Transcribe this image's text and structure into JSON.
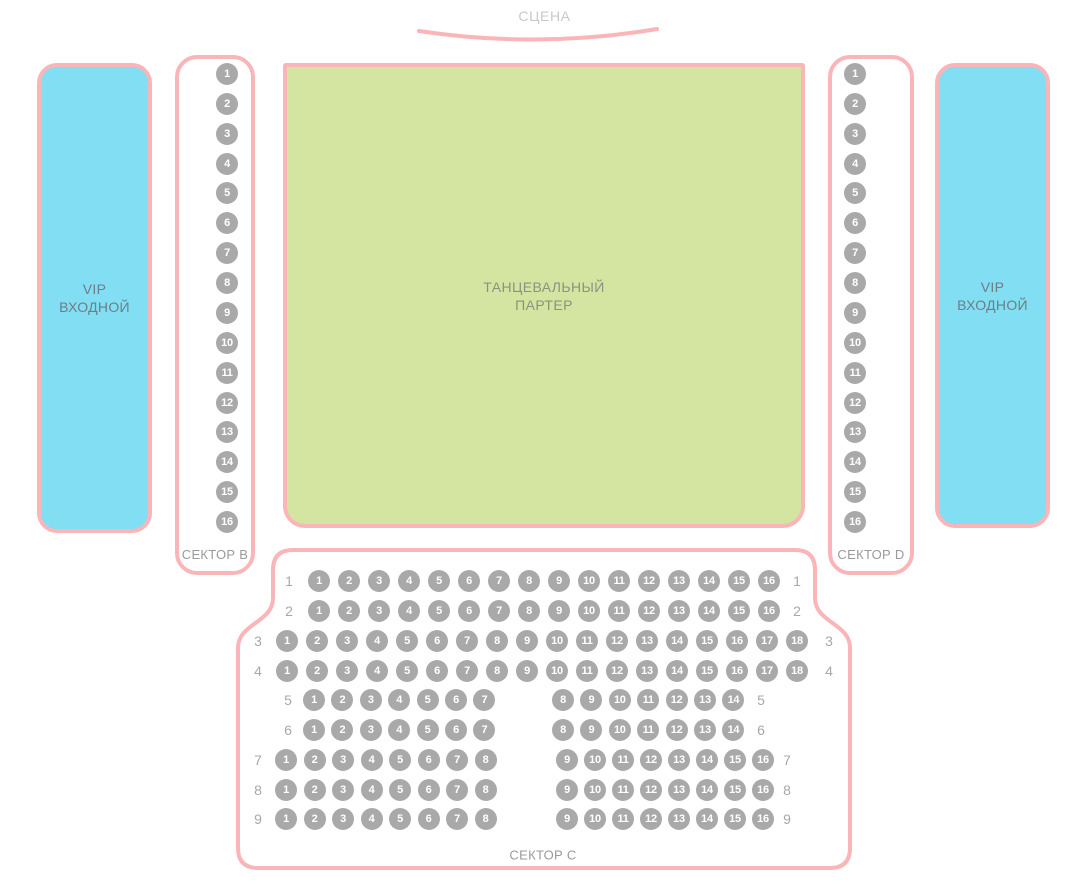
{
  "colors": {
    "pink": "#f9b5b8",
    "cyan": "#82def2",
    "green": "#d3e5a1",
    "seat": "#a9a9a9",
    "seat_number": "#ffffff"
  },
  "stage": {
    "label": "СЦЕНА"
  },
  "vip_left": {
    "line1": "VIP",
    "line2": "ВХОДНОЙ"
  },
  "vip_right": {
    "line1": "VIP",
    "line2": "ВХОДНОЙ"
  },
  "dance_floor": {
    "line1": "ТАНЦЕВАЛЬНЫЙ",
    "line2": "ПАРТЕР"
  },
  "sector_b": {
    "label": "СЕКТОР B",
    "seats": [
      "1",
      "2",
      "3",
      "4",
      "5",
      "6",
      "7",
      "8",
      "9",
      "10",
      "11",
      "12",
      "13",
      "14",
      "15",
      "16"
    ]
  },
  "sector_d": {
    "label": "СЕКТОР D",
    "seats": [
      "1",
      "2",
      "3",
      "4",
      "5",
      "6",
      "7",
      "8",
      "9",
      "10",
      "11",
      "12",
      "13",
      "14",
      "15",
      "16"
    ]
  },
  "sector_c": {
    "label": "СЕКТОР C",
    "rows": [
      {
        "label": "1",
        "groups": [
          [
            "1",
            "2",
            "3",
            "4",
            "5",
            "6",
            "7",
            "8",
            "9",
            "10",
            "11",
            "12",
            "13",
            "14",
            "15",
            "16"
          ]
        ]
      },
      {
        "label": "2",
        "groups": [
          [
            "1",
            "2",
            "3",
            "4",
            "5",
            "6",
            "7",
            "8",
            "9",
            "10",
            "11",
            "12",
            "13",
            "14",
            "15",
            "16"
          ]
        ]
      },
      {
        "label": "3",
        "groups": [
          [
            "1",
            "2",
            "3",
            "4",
            "5",
            "6",
            "7",
            "8",
            "9",
            "10",
            "11",
            "12",
            "13",
            "14",
            "15",
            "16",
            "17",
            "18"
          ]
        ]
      },
      {
        "label": "4",
        "groups": [
          [
            "1",
            "2",
            "3",
            "4",
            "5",
            "6",
            "7",
            "8",
            "9",
            "10",
            "11",
            "12",
            "13",
            "14",
            "15",
            "16",
            "17",
            "18"
          ]
        ]
      },
      {
        "label": "5",
        "groups": [
          [
            "1",
            "2",
            "3",
            "4",
            "5",
            "6",
            "7"
          ],
          [
            "8",
            "9",
            "10",
            "11",
            "12",
            "13",
            "14"
          ]
        ]
      },
      {
        "label": "6",
        "groups": [
          [
            "1",
            "2",
            "3",
            "4",
            "5",
            "6",
            "7"
          ],
          [
            "8",
            "9",
            "10",
            "11",
            "12",
            "13",
            "14"
          ]
        ]
      },
      {
        "label": "7",
        "groups": [
          [
            "1",
            "2",
            "3",
            "4",
            "5",
            "6",
            "7",
            "8"
          ],
          [
            "9",
            "10",
            "11",
            "12",
            "13",
            "14",
            "15",
            "16"
          ]
        ]
      },
      {
        "label": "8",
        "groups": [
          [
            "1",
            "2",
            "3",
            "4",
            "5",
            "6",
            "7",
            "8"
          ],
          [
            "9",
            "10",
            "11",
            "12",
            "13",
            "14",
            "15",
            "16"
          ]
        ]
      },
      {
        "label": "9",
        "groups": [
          [
            "1",
            "2",
            "3",
            "4",
            "5",
            "6",
            "7",
            "8"
          ],
          [
            "9",
            "10",
            "11",
            "12",
            "13",
            "14",
            "15",
            "16"
          ]
        ]
      }
    ]
  }
}
